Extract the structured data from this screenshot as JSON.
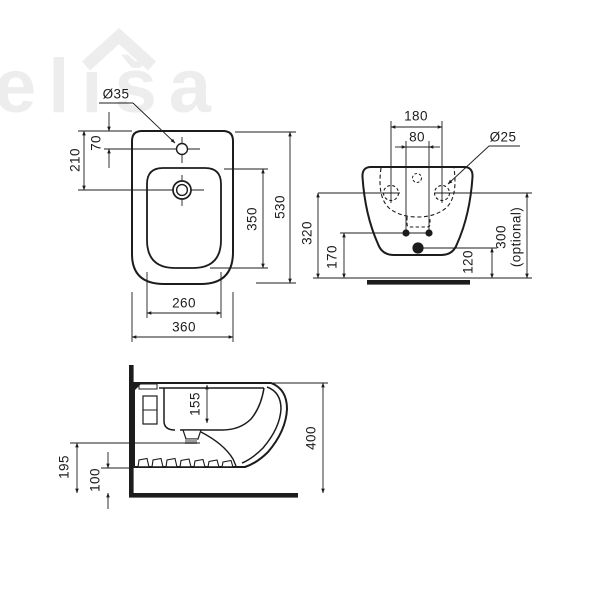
{
  "watermark": {
    "text": "eliša"
  },
  "plan": {
    "hole": "Ø35",
    "h70": "70",
    "h210": "210",
    "h350": "350",
    "h530": "530",
    "h260": "260",
    "h360": "360"
  },
  "front": {
    "h180": "180",
    "h80": "80",
    "hole": "Ø25",
    "h320": "320",
    "h170": "170",
    "h120": "120",
    "h300": "300",
    "h300note": "(optional)"
  },
  "side": {
    "h155": "155",
    "h400": "400",
    "h195": "195",
    "h100": "100"
  },
  "colors": {
    "line": "#1c1c1c",
    "watermark": "#ededed",
    "outlet_gray": "#9b9b9b"
  }
}
